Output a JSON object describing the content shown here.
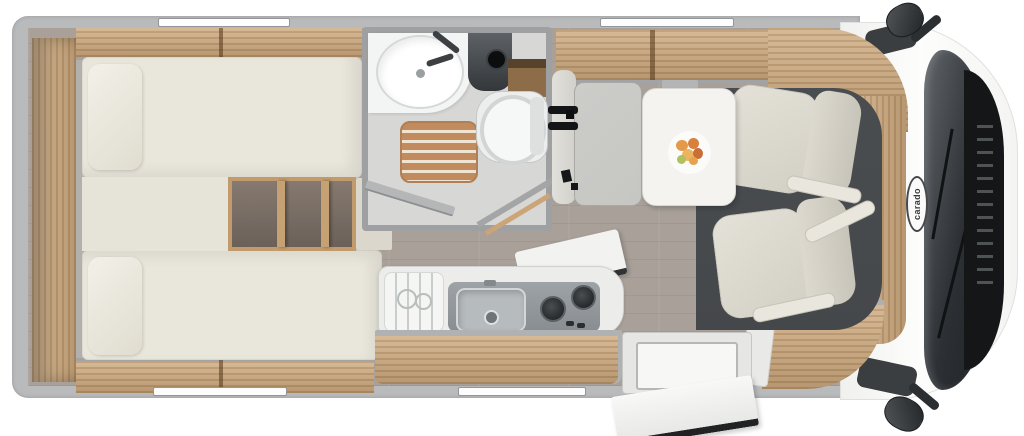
{
  "cab": {
    "brand_label": "carado"
  },
  "palette": {
    "wall": "#b9babc",
    "floor": "#a8a099",
    "wood": "#cba577",
    "mattress": "#e9e6db",
    "cushion": "#c6c6c3",
    "seat": "#dedbd2",
    "mat": "#45484b",
    "bath-floor": "#d7d7d5",
    "table": "#f4f3ef",
    "windshield": "#2c3034"
  }
}
